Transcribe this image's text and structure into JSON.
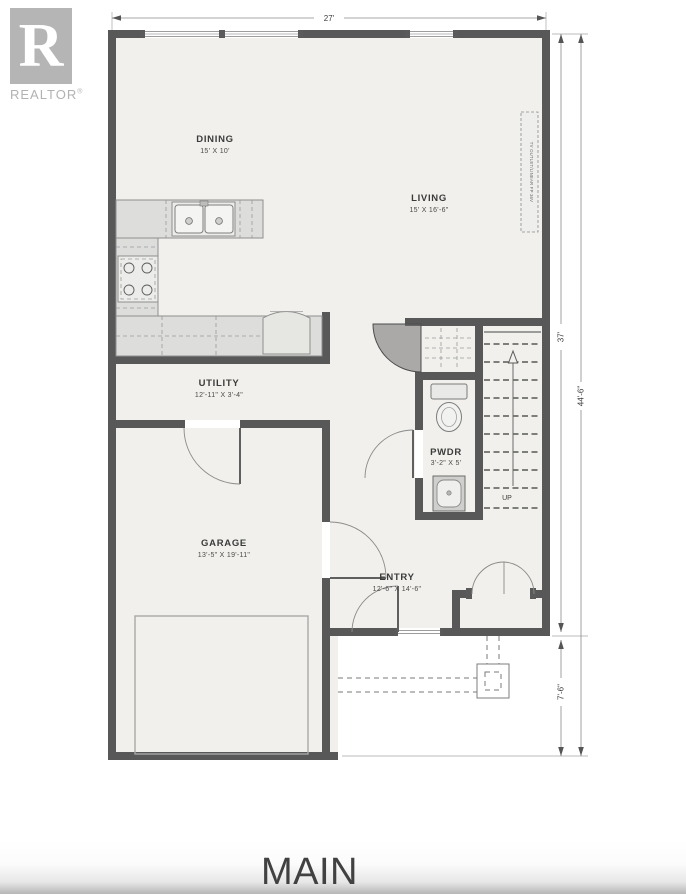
{
  "logo": {
    "letter": "R",
    "brand": "REALTOR",
    "registered": "®"
  },
  "floor_label": "MAIN",
  "rooms": {
    "dining": {
      "name": "DINING",
      "dims": "15' X 10'"
    },
    "living": {
      "name": "LIVING",
      "dims": "15' X 16'-6\""
    },
    "utility": {
      "name": "UTILITY",
      "dims": "12'-11\" X 3'-4\""
    },
    "garage": {
      "name": "GARAGE",
      "dims": "13'-5\" X 19'-11\""
    },
    "powder": {
      "name": "PWDR",
      "dims": "3'-2\" X 5'"
    },
    "entry": {
      "name": "ENTRY",
      "dims": "12'-6\" X 14'-6\""
    }
  },
  "dimensions": {
    "width_top": "27'",
    "height_main": "37'",
    "height_total": "44'-6\"",
    "porch_depth": "7'-6\""
  },
  "annotations": {
    "stairs_direction": "UP",
    "fireplace": "TV OUTLET/LINEAR FP 36V"
  },
  "colors": {
    "wall": "#585858",
    "floor": "#f1f0ec",
    "logo_gray": "#b5b5b5",
    "label_text": "#3b3b3b"
  }
}
